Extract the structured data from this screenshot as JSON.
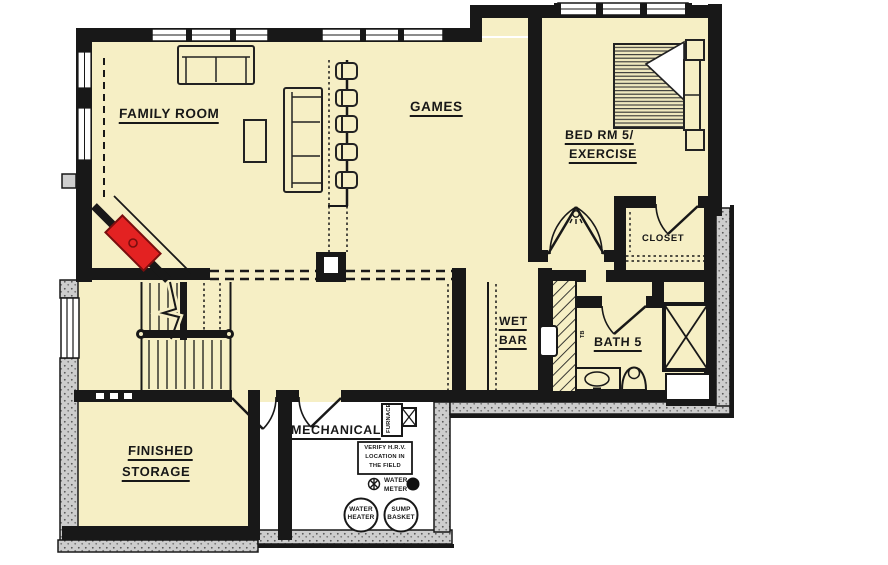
{
  "rooms": {
    "family_room": "FAMILY ROOM",
    "games": "GAMES",
    "bedroom_line1": "BED RM 5/",
    "bedroom_line2": "EXERCISE",
    "closet": "CLOSET",
    "wet_bar_line1": "WET",
    "wet_bar_line2": "BAR",
    "bath": "BATH 5",
    "storage_line1": "FINISHED",
    "storage_line2": "STORAGE",
    "mechanical": "MECHANICAL"
  },
  "equipment": {
    "furnace": "FURNACE",
    "hrv_note_line1": "VERIFY H.R.V.",
    "hrv_note_line2": "LOCATION IN",
    "hrv_note_line3": "THE FIELD",
    "water_meter_line1": "WATER",
    "water_meter_line2": "METER",
    "water_heater_line1": "WATER",
    "water_heater_line2": "HEATER",
    "sump_basket_line1": "SUMP",
    "sump_basket_line2": "BASKET",
    "towel_bar": "TB"
  },
  "colors": {
    "room_fill": "#F6EFC5",
    "wall": "#181818",
    "fireplace": "#E32222",
    "foundation_stipple": "#CDCDCD",
    "background": "#FFFFFF"
  }
}
